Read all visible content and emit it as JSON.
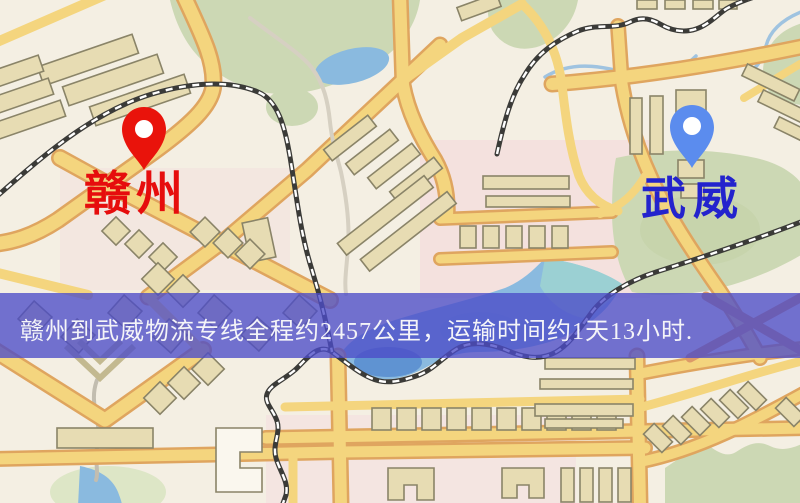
{
  "banner": {
    "text": "赣州到武威物流专线全程约2457公里，运输时间约1天13小时.",
    "background_color": "#4b4bc8",
    "text_color": "#f4f4f8"
  },
  "markers": {
    "origin": {
      "label": "赣州",
      "pin_color": "#e9130b",
      "label_color": "#e60d0d"
    },
    "destination": {
      "label": "武威",
      "pin_color": "#5b8cee",
      "label_color": "#2323cd"
    }
  },
  "map": {
    "palette": {
      "background": "#f4efe3",
      "park": "#ccd8b4",
      "water": "#8abadf",
      "water_deep": "#5f93d2",
      "river": "#9fc3e0",
      "road": "#f4d57e",
      "road_casing": "#dfa55f",
      "road_warm": "#dc9a68",
      "path_minor": "#d6d0c2",
      "railway": "#3b3b38",
      "building": "#e7dcb3",
      "building_stroke": "#8a8468"
    }
  }
}
